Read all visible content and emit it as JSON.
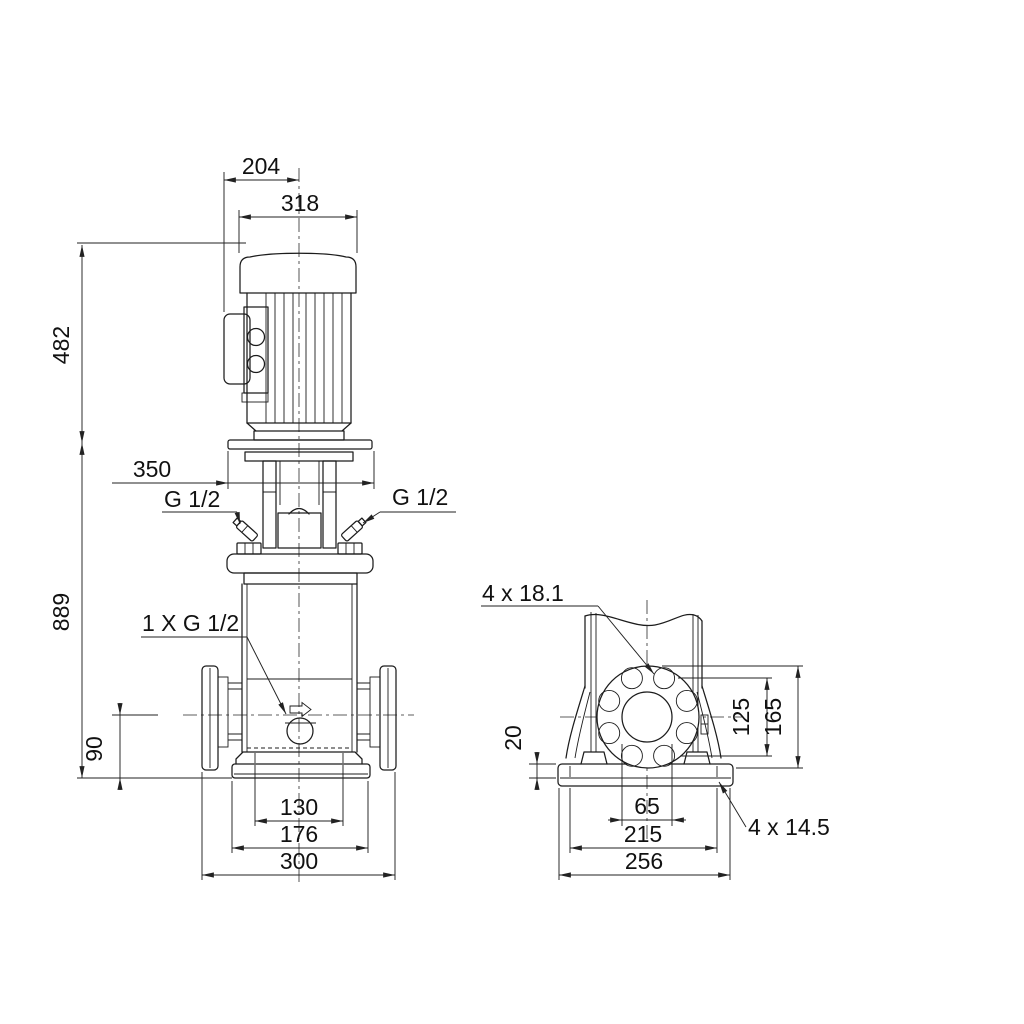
{
  "drawing": {
    "front_view": {
      "motor_offset_204": "204",
      "motor_width_318": "318",
      "motor_height_482": "482",
      "head_width_350": "350",
      "plug_left": "G 1/2",
      "plug_right": "G 1/2",
      "total_height_889": "889",
      "drain_port": "1 X G 1/2",
      "port_height_90": "90",
      "base_holes_130": "130",
      "base_width_176": "176",
      "port_span_300": "300"
    },
    "side_view": {
      "flange_holes": "4 x 18.1",
      "base_plate_20": "20",
      "bolt_circle_125": "125",
      "flange_height_165": "165",
      "bore_65": "65",
      "base_holes_span_215": "215",
      "base_width_256": "256",
      "base_holes": "4 x 14.5"
    }
  }
}
